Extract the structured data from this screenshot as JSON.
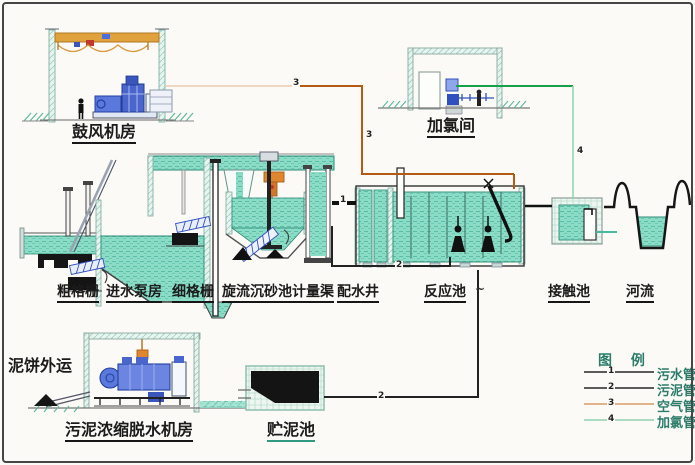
{
  "units": {
    "blower_room": "鼓风机房",
    "chlorination_room": "加氯间",
    "coarse_screen": "粗格栅",
    "inlet_pump_house": "进水泵房",
    "fine_screen": "细格栅",
    "vortex_grit_chamber": "旋流沉砂池",
    "measuring_channel": "计量渠",
    "distribution_well": "配水井",
    "reaction_tank": "反应池",
    "reaction_tank_mark": "~",
    "contact_tank": "接触池",
    "river": "河流",
    "sludge_cake_out": "泥饼外运",
    "sludge_dewatering_room": "污泥浓缩脱水机房",
    "sludge_storage_tank": "贮泥池"
  },
  "legend": {
    "title": "图 例",
    "items": [
      {
        "num": "1",
        "label": "污水管",
        "line_color": "#262626"
      },
      {
        "num": "2",
        "label": "污泥管",
        "line_color": "#262626"
      },
      {
        "num": "3",
        "label": "空气管",
        "line_color": "#cf8a45"
      },
      {
        "num": "4",
        "label": "加氯管",
        "line_color": "#7bc9a2"
      }
    ]
  },
  "pipe_markers": {
    "sewage": "1",
    "sludge": "2",
    "air": "3",
    "chlorine": "4"
  },
  "colors": {
    "water": "#8bdcc7",
    "water_edge": "#2e8a74",
    "air_pipe": "#b45a14",
    "chlorine_pipe": "#18a14b",
    "machinery_blue": "#4a66cc",
    "crane_orange": "#e0a23c",
    "sludge_black": "#141414"
  }
}
